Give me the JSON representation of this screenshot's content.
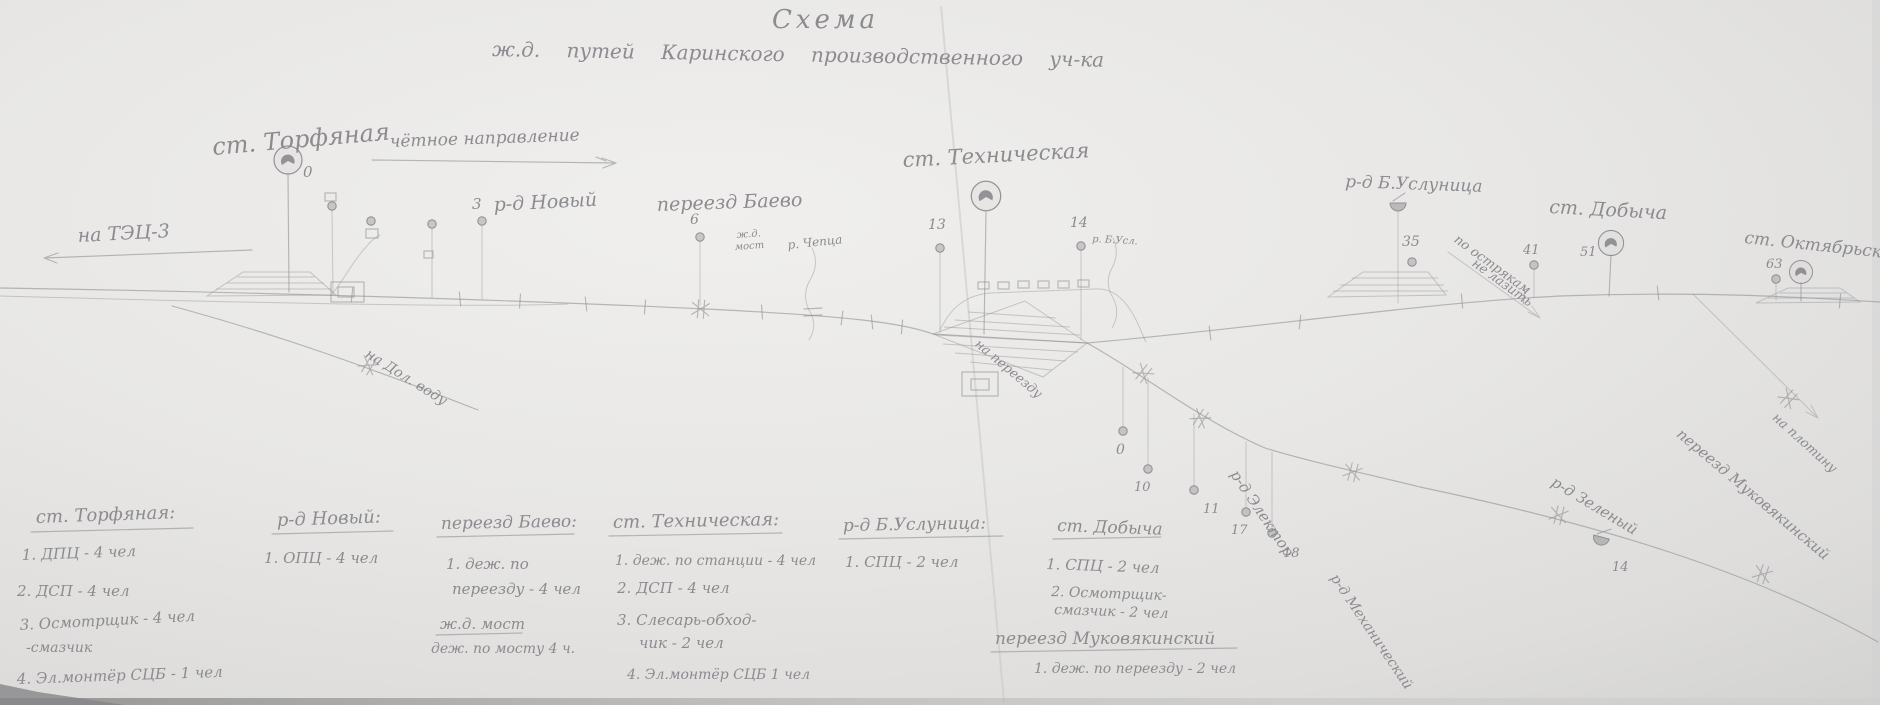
{
  "page": {
    "background": "#e7e6e4",
    "pencil": "#8d8d92"
  },
  "title": {
    "main": "Схема",
    "subtitle": "ж.д. путей  Каринского  производственного  уч-ка"
  },
  "map": {
    "direction_note": "чётное направление",
    "left_branch_label": "на ТЭЦ-3",
    "dolvoda_branch_label": "на Дол. воду",
    "stations": [
      {
        "label": "ст. Торфяная",
        "num": "0"
      },
      {
        "label": "р-д Новый",
        "num": "3"
      },
      {
        "label": "переезд Баево",
        "num": "6"
      },
      {
        "label": "ст. Техническая",
        "num": "13",
        "num2": "14"
      },
      {
        "label": "р-д Б.Услуница",
        "num": "35"
      },
      {
        "label": "ст. Добыча",
        "num": "41",
        "num2": "51"
      },
      {
        "label": "ст. Октябрьская",
        "num": "63"
      }
    ],
    "river_cheptsa": "р. Чепца",
    "bridge_label_1": "ж.д.",
    "bridge_label_2": "мост",
    "river_uslunitsa": "р. Б.Усл.",
    "note_to_crossing": "на переезду",
    "warning_line1": "по острякам",
    "warning_line2": "не лазить",
    "note_to_dam": "на плотину",
    "crossing_mukov": "переезд Муковякинский",
    "stop_elektor": "р-д Электор",
    "stop_mekh": "р-д Механический",
    "stop_zeleny": "р-д Зеленый",
    "stop_zeleny_num": "14",
    "branch_nums": [
      "0",
      "10",
      "11",
      "17",
      "18"
    ]
  },
  "legend": {
    "groups": [
      {
        "title": "ст. Торфяная:",
        "lines": [
          "1. ДПЦ - 4 чел",
          "2. ДСП - 4 чел",
          "3. Осмотрщик - 4 чел",
          "-смазчик",
          "4. Эл.монтёр СЦБ - 1 чел"
        ]
      },
      {
        "title": "р-д Новый:",
        "lines": [
          "1. ОПЦ - 4 чел"
        ]
      },
      {
        "title": "переезд Баево:",
        "lines": [
          "1. деж. по",
          "переезду - 4 чел"
        ],
        "title2": "ж.д. мост",
        "lines2": [
          "деж. по мосту 4 ч."
        ]
      },
      {
        "title": "ст. Техническая:",
        "lines": [
          "1. деж. по станции - 4 чел",
          "2. ДСП - 4 чел",
          "3. Слесарь-обход-",
          "чик - 2 чел",
          "4. Эл.монтёр СЦБ 1 чел"
        ]
      },
      {
        "title": "р-д Б.Услуница:",
        "lines": [
          "1. СПЦ - 2 чел"
        ]
      },
      {
        "title": "ст. Добыча",
        "lines": [
          "1. СПЦ - 2 чел",
          "2. Осмотрщик-",
          "смазчик - 2 чел"
        ]
      },
      {
        "title": "переезд Муковякинский",
        "lines": [
          "1. деж. по переезду - 2 чел"
        ]
      }
    ]
  }
}
